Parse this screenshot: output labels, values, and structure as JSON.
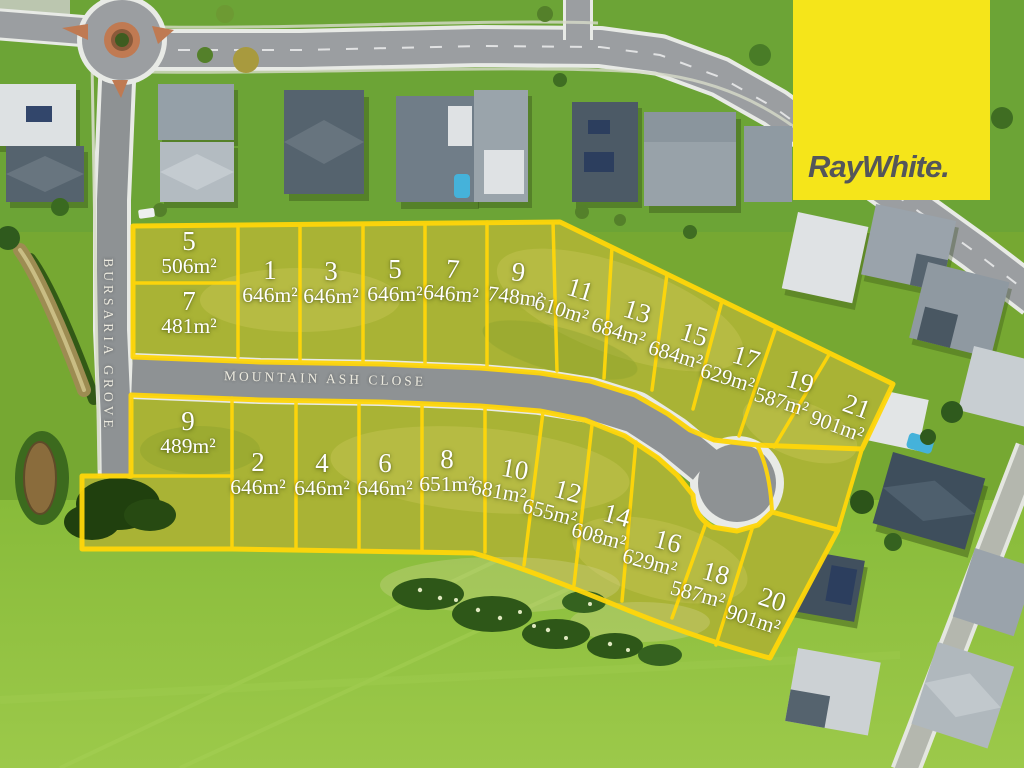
{
  "brand": {
    "logo_text": "RayWhite.",
    "logo_bg": "#F5E51A",
    "logo_text_color": "#54565A"
  },
  "streets": {
    "main": "MOUNTAIN ASH CLOSE",
    "side": "BURSARIA GROVE"
  },
  "overlay": {
    "line_color": "#FFD60A",
    "label_color": "#FFFFFF"
  },
  "lots": [
    {
      "lot": "5",
      "area": "506m²",
      "x": 189,
      "y": 252,
      "rot": 0
    },
    {
      "lot": "7",
      "area": "481m²",
      "x": 189,
      "y": 312,
      "rot": 0
    },
    {
      "lot": "1",
      "area": "646m²",
      "x": 270,
      "y": 281,
      "rot": 0
    },
    {
      "lot": "3",
      "area": "646m²",
      "x": 331,
      "y": 282,
      "rot": 0
    },
    {
      "lot": "5",
      "area": "646m²",
      "x": 395,
      "y": 280,
      "rot": 0
    },
    {
      "lot": "7",
      "area": "646m²",
      "x": 452,
      "y": 280,
      "rot": 4
    },
    {
      "lot": "9",
      "area": "748m²",
      "x": 517,
      "y": 283,
      "rot": 7
    },
    {
      "lot": "11",
      "area": "610m²",
      "x": 577,
      "y": 300,
      "rot": 17
    },
    {
      "lot": "13",
      "area": "684m²",
      "x": 634,
      "y": 322,
      "rot": 17
    },
    {
      "lot": "15",
      "area": "684m²",
      "x": 691,
      "y": 345,
      "rot": 17
    },
    {
      "lot": "17",
      "area": "629m²",
      "x": 743,
      "y": 368,
      "rot": 17
    },
    {
      "lot": "19",
      "area": "587m²",
      "x": 797,
      "y": 392,
      "rot": 17
    },
    {
      "lot": "21",
      "area": "901m²",
      "x": 853,
      "y": 417,
      "rot": 20
    },
    {
      "lot": "9",
      "area": "489m²",
      "x": 188,
      "y": 432,
      "rot": 0
    },
    {
      "lot": "2",
      "area": "646m²",
      "x": 258,
      "y": 473,
      "rot": 0
    },
    {
      "lot": "4",
      "area": "646m²",
      "x": 322,
      "y": 474,
      "rot": 0
    },
    {
      "lot": "6",
      "area": "646m²",
      "x": 385,
      "y": 474,
      "rot": 0
    },
    {
      "lot": "8",
      "area": "651m²",
      "x": 447,
      "y": 470,
      "rot": 0
    },
    {
      "lot": "10",
      "area": "681m²",
      "x": 513,
      "y": 480,
      "rot": 10
    },
    {
      "lot": "12",
      "area": "655m²",
      "x": 565,
      "y": 502,
      "rot": 15
    },
    {
      "lot": "14",
      "area": "608m²",
      "x": 614,
      "y": 526,
      "rot": 15
    },
    {
      "lot": "16",
      "area": "629m²",
      "x": 665,
      "y": 552,
      "rot": 15
    },
    {
      "lot": "18",
      "area": "587m²",
      "x": 713,
      "y": 584,
      "rot": 15
    },
    {
      "lot": "20",
      "area": "901m²",
      "x": 769,
      "y": 610,
      "rot": 18
    }
  ]
}
